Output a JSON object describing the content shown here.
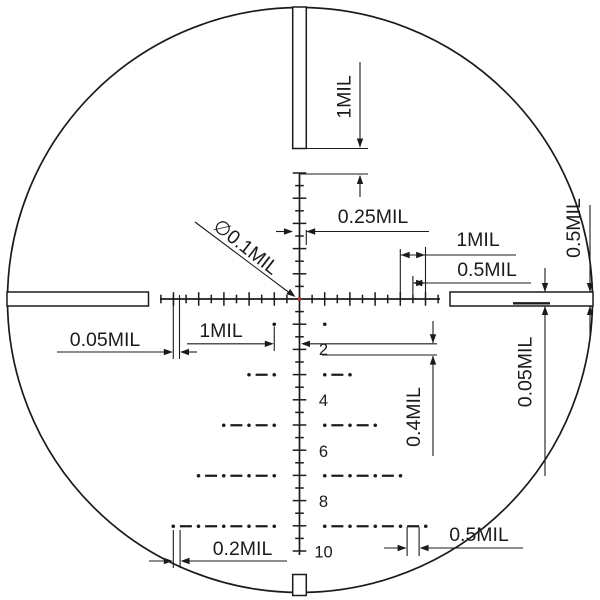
{
  "diagram": {
    "title": "mil-reticle-subtension-diagram",
    "unit": "MIL",
    "background": "#ffffff",
    "ink": "#1b1b1b",
    "center_dot_color": "#9e3a32",
    "circle": {
      "cx": 300,
      "cy": 300,
      "r": 292.5
    },
    "center": {
      "x": 299.5,
      "y": 299,
      "dot_r": 2
    },
    "mil_px": 25.25,
    "ticks": {
      "half_step": 12.6,
      "major_half": 6.8,
      "minor_half": 4.3,
      "up": 10,
      "down": 20,
      "left": 11,
      "right": 11
    },
    "lines": {
      "stroke": 1.7,
      "v_top": 173,
      "v_bottom": 555,
      "h_left": 160,
      "h_right": 440
    },
    "posts": {
      "stroke": 1.5,
      "top": {
        "x": 292.7,
        "y": 7,
        "w": 13.6,
        "h": 141.5
      },
      "left": {
        "x": 7,
        "y": 292,
        "w": 141.5,
        "h": 14
      },
      "right": {
        "x": 450,
        "y": 292,
        "w": 143,
        "h": 14
      },
      "bottom": {
        "x": 292.7,
        "y": 574.5,
        "w": 13.6,
        "h": 21
      },
      "wire_sample": {
        "x1": 513,
        "y1": 303.3,
        "x2": 550,
        "y2": 303.3,
        "w": 2.4
      }
    },
    "tree": {
      "dot_r": 1.8,
      "dash_len": 12,
      "dash_w": 2.2,
      "number_font": 16.5,
      "number_x": 323.5,
      "rows": [
        {
          "mil": 1,
          "span": 1
        },
        {
          "mil": 3,
          "span": 2
        },
        {
          "mil": 5,
          "span": 3
        },
        {
          "mil": 7,
          "span": 4
        },
        {
          "mil": 9,
          "span": 5
        }
      ],
      "numbers": [
        {
          "label": "2",
          "y": 355
        },
        {
          "label": "4",
          "y": 406
        },
        {
          "label": "6",
          "y": 457
        },
        {
          "label": "8",
          "y": 507
        },
        {
          "label": "10",
          "y": 557.5
        }
      ]
    },
    "annotations": [
      {
        "id": "top-post-gap",
        "label": "1MIL",
        "lx": 350.5,
        "ly": 97,
        "rot": -90,
        "font": 19.5,
        "segs": [
          [
            360,
            62,
            360,
            147
          ],
          [
            307,
            148.5,
            368,
            148.5
          ],
          [
            300.5,
            174,
            368,
            174
          ],
          [
            360,
            176,
            360,
            197
          ]
        ],
        "arrows": [
          [
            360,
            147.5,
            90
          ],
          [
            360,
            175,
            270
          ]
        ]
      },
      {
        "id": "tick-width",
        "label": "0.25MIL",
        "lx": 373,
        "ly": 223,
        "rot": 0,
        "font": 19.5,
        "segs": [
          [
            276,
            231.5,
            292,
            231.5
          ],
          [
            307,
            231.5,
            429,
            231.5
          ],
          [
            306.3,
            230,
            306.3,
            245
          ]
        ],
        "arrows": [
          [
            292.9,
            231.5,
            0
          ],
          [
            306.2,
            231.5,
            180
          ]
        ]
      },
      {
        "id": "right-major-spacing",
        "label": "1MIL",
        "lx": 478,
        "ly": 246,
        "rot": 0,
        "font": 19.5,
        "segs": [
          [
            400.3,
            249,
            400.3,
            295
          ],
          [
            425.5,
            247,
            425.5,
            295
          ],
          [
            400.3,
            255,
            516,
            255
          ]
        ],
        "arrows": [
          [
            400.7,
            255,
            180
          ],
          [
            425.1,
            255,
            0
          ]
        ]
      },
      {
        "id": "right-minor-spacing",
        "label": "0.5MIL",
        "lx": 487,
        "ly": 276,
        "rot": 0,
        "font": 19.5,
        "segs": [
          [
            412.9,
            276,
            412.9,
            295
          ],
          [
            412.9,
            283,
            531,
            283
          ]
        ],
        "arrows": [
          [
            413.3,
            283,
            180
          ],
          [
            425.1,
            283,
            0
          ]
        ]
      },
      {
        "id": "post-thickness",
        "label": "0.5MIL",
        "lx": 580,
        "ly": 228,
        "rot": -90,
        "font": 19.5,
        "segs": [
          [
            590,
            205,
            590,
            291.5
          ],
          [
            590,
            306.5,
            590,
            337
          ]
        ],
        "arrows": [
          [
            590,
            292,
            90
          ],
          [
            590,
            306,
            270
          ]
        ]
      },
      {
        "id": "wire-thickness",
        "label": "0.05MIL",
        "lx": 531.5,
        "ly": 372,
        "rot": -90,
        "font": 19.5,
        "segs": [
          [
            545,
            268,
            545,
            291.5
          ],
          [
            545,
            306.5,
            545,
            476
          ]
        ],
        "arrows": [
          [
            545,
            292,
            90
          ],
          [
            545,
            306,
            270
          ]
        ]
      },
      {
        "id": "left-wire-tip",
        "label": "0.05MIL",
        "lx": 105,
        "ly": 346,
        "rot": 0,
        "font": 19.5,
        "segs": [
          [
            173.3,
            295,
            173.3,
            359
          ],
          [
            179.5,
            295,
            179.5,
            359
          ],
          [
            57,
            352,
            170,
            352
          ],
          [
            182.5,
            352,
            197,
            352
          ]
        ],
        "arrows": [
          [
            172.8,
            352,
            0
          ],
          [
            180,
            352,
            180
          ]
        ]
      },
      {
        "id": "tree-column-spacing",
        "label": "1MIL",
        "lx": 221,
        "ly": 337,
        "rot": 0,
        "font": 19.5,
        "segs": [
          [
            274.25,
            326.5,
            274.25,
            351
          ],
          [
            187,
            343.8,
            270,
            343.8
          ],
          [
            303,
            343.8,
            437,
            343.8
          ]
        ],
        "arrows": [
          [
            273.8,
            343.8,
            0
          ],
          [
            301,
            343.8,
            180
          ]
        ]
      },
      {
        "id": "digit-height",
        "label": "0.4MIL",
        "lx": 420,
        "ly": 417,
        "rot": -90,
        "font": 19.5,
        "segs": [
          [
            322,
            355,
            437,
            355
          ],
          [
            433,
            321,
            433,
            343
          ],
          [
            433,
            356,
            433,
            456
          ]
        ],
        "arrows": [
          [
            433,
            343.3,
            90
          ],
          [
            433,
            355.6,
            270
          ]
        ]
      },
      {
        "id": "dot-dash-gap",
        "label": "0.2MIL",
        "lx": 242.5,
        "ly": 555,
        "rot": 0,
        "font": 19.5,
        "segs": [
          [
            173.3,
            530,
            173.3,
            568
          ],
          [
            180.1,
            530,
            180.1,
            568
          ],
          [
            149,
            561,
            170,
            561
          ],
          [
            183,
            561,
            287,
            561
          ]
        ],
        "arrows": [
          [
            172.8,
            561,
            0
          ],
          [
            180.6,
            561,
            180
          ]
        ]
      },
      {
        "id": "dash-length",
        "label": "0.5MIL",
        "lx": 479,
        "ly": 541,
        "rot": 0,
        "font": 19.5,
        "segs": [
          [
            407.1,
            527,
            407.1,
            556
          ],
          [
            419.1,
            527,
            419.1,
            556
          ],
          [
            384,
            548,
            404.5,
            548
          ],
          [
            421.7,
            548,
            523,
            548
          ]
        ],
        "arrows": [
          [
            406.6,
            548,
            0
          ],
          [
            419.6,
            548,
            180
          ]
        ]
      },
      {
        "id": "center-dot-diameter",
        "label": "∅0.1MIL",
        "lx": 242,
        "ly": 252,
        "rot": 38,
        "font": 19.5,
        "segs": [
          [
            195,
            222,
            293,
            295.5
          ]
        ],
        "arrows": [
          [
            295.5,
            297,
            37
          ]
        ]
      }
    ]
  }
}
